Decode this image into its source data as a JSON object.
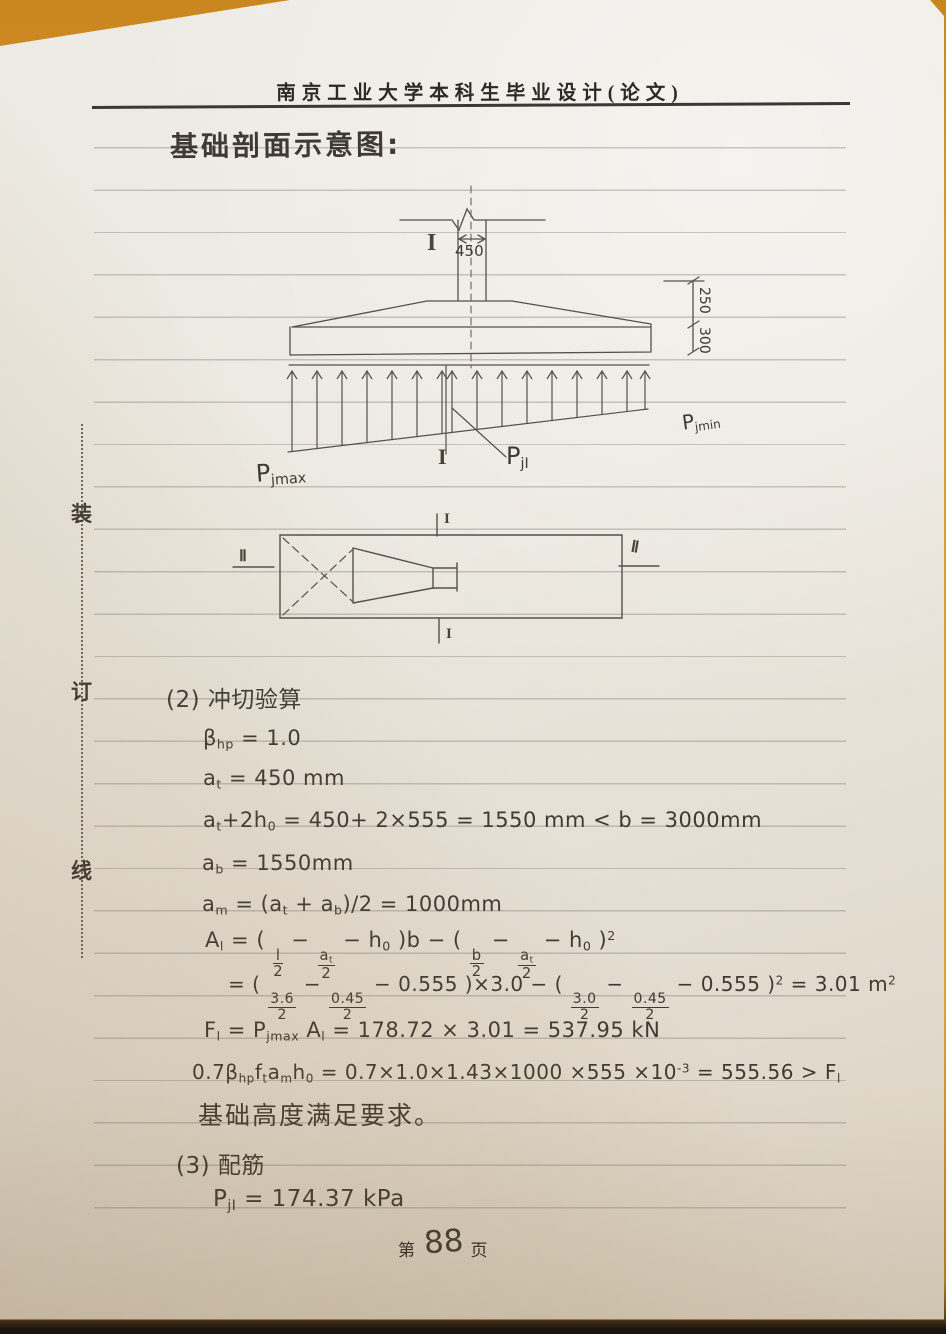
{
  "colors": {
    "desk": "#d8922d",
    "paper": "#eae6de",
    "ink": "#3f3a33",
    "print": "#2d2a26"
  },
  "header": {
    "title": "南京工业大学本科生毕业设计(论文)"
  },
  "title": {
    "text": "基础剖面示意图:"
  },
  "binding": {
    "chars": [
      "装",
      "订",
      "线"
    ]
  },
  "diagram": {
    "column_width": "450",
    "dim_upper": "250",
    "dim_lower": "300",
    "sec_I": "I",
    "sec_II": "Ⅱ",
    "p_max": [
      {
        "t": "P"
      },
      {
        "sub": "jmax"
      }
    ],
    "p_min": [
      {
        "t": "P"
      },
      {
        "sub": "jmin"
      }
    ],
    "p_mid": [
      {
        "t": "P"
      },
      {
        "sub": "jI"
      }
    ]
  },
  "formulas": {
    "h_punching": "(2) 冲切验算",
    "bhp": [
      {
        "t": "β"
      },
      {
        "sub": "hp"
      },
      {
        "t": " = 1.0"
      }
    ],
    "at": [
      {
        "t": "a"
      },
      {
        "sub": "t"
      },
      {
        "t": " = 450 mm"
      }
    ],
    "at2h0": [
      {
        "t": "a"
      },
      {
        "sub": "t"
      },
      {
        "t": "+2h"
      },
      {
        "sub": "0"
      },
      {
        "t": " = 450+ 2×555 = 1550 mm < b = 3000mm"
      }
    ],
    "ab": [
      {
        "t": "a"
      },
      {
        "sub": "b"
      },
      {
        "t": " = 1550mm"
      }
    ],
    "am": [
      {
        "t": "a"
      },
      {
        "sub": "m"
      },
      {
        "t": " = (a"
      },
      {
        "sub": "t"
      },
      {
        "t": " + a"
      },
      {
        "sub": "b"
      },
      {
        "t": ")/2 = 1000mm"
      }
    ],
    "Al": [
      {
        "t": "A"
      },
      {
        "sub": "l"
      },
      {
        "t": " = ( "
      },
      {
        "frac": {
          "n": [
            {
              "t": "l"
            }
          ],
          "d": [
            {
              "t": "2"
            }
          ]
        }
      },
      {
        "t": " − "
      },
      {
        "frac": {
          "n": [
            {
              "t": "a"
            },
            {
              "sub": "t"
            }
          ],
          "d": [
            {
              "t": "2"
            }
          ]
        }
      },
      {
        "t": " − h"
      },
      {
        "sub": "0"
      },
      {
        "t": " )b − ( "
      },
      {
        "frac": {
          "n": [
            {
              "t": "b"
            }
          ],
          "d": [
            {
              "t": "2"
            }
          ]
        }
      },
      {
        "t": " − "
      },
      {
        "frac": {
          "n": [
            {
              "t": "a"
            },
            {
              "sub": "t"
            }
          ],
          "d": [
            {
              "t": "2"
            }
          ]
        }
      },
      {
        "t": " − h"
      },
      {
        "sub": "0"
      },
      {
        "t": " )"
      },
      {
        "sup": "2"
      }
    ],
    "Al2": [
      {
        "t": "= ( "
      },
      {
        "frac": {
          "n": [
            {
              "t": "3.6"
            }
          ],
          "d": [
            {
              "t": "2"
            }
          ]
        }
      },
      {
        "t": " − "
      },
      {
        "frac": {
          "n": [
            {
              "t": "0.45"
            }
          ],
          "d": [
            {
              "t": "2"
            }
          ]
        }
      },
      {
        "t": " − 0.555 )×3.0 − ( "
      },
      {
        "frac": {
          "n": [
            {
              "t": "3.0"
            }
          ],
          "d": [
            {
              "t": "2"
            }
          ]
        }
      },
      {
        "t": " − "
      },
      {
        "frac": {
          "n": [
            {
              "t": "0.45"
            }
          ],
          "d": [
            {
              "t": "2"
            }
          ]
        }
      },
      {
        "t": " − 0.555 )"
      },
      {
        "sup": "2"
      },
      {
        "t": " = 3.01 m"
      },
      {
        "sup": "2"
      }
    ],
    "Fl": [
      {
        "t": "F"
      },
      {
        "sub": "l"
      },
      {
        "t": " = P"
      },
      {
        "sub": "jmax"
      },
      {
        "t": " A"
      },
      {
        "sub": "l"
      },
      {
        "t": " = 178.72 × 3.01 = 537.95 kN"
      }
    ],
    "punch": [
      {
        "t": "0.7β"
      },
      {
        "sub": "hp"
      },
      {
        "t": "f"
      },
      {
        "sub": "t"
      },
      {
        "t": "a"
      },
      {
        "sub": "m"
      },
      {
        "t": "h"
      },
      {
        "sub": "0"
      },
      {
        "t": " = 0.7×1.0×1.43×1000 ×555 ×10"
      },
      {
        "sup": "-3"
      },
      {
        "t": " = 555.56 > F"
      },
      {
        "sub": "l"
      }
    ],
    "conclusion": "基础高度满足要求。",
    "h_rebar": "(3) 配筋",
    "pjI": [
      {
        "t": "P"
      },
      {
        "sub": "jI"
      },
      {
        "t": " = 174.37 kPa"
      }
    ]
  },
  "footer": {
    "prefix": "第",
    "number": "88",
    "suffix": "页"
  }
}
